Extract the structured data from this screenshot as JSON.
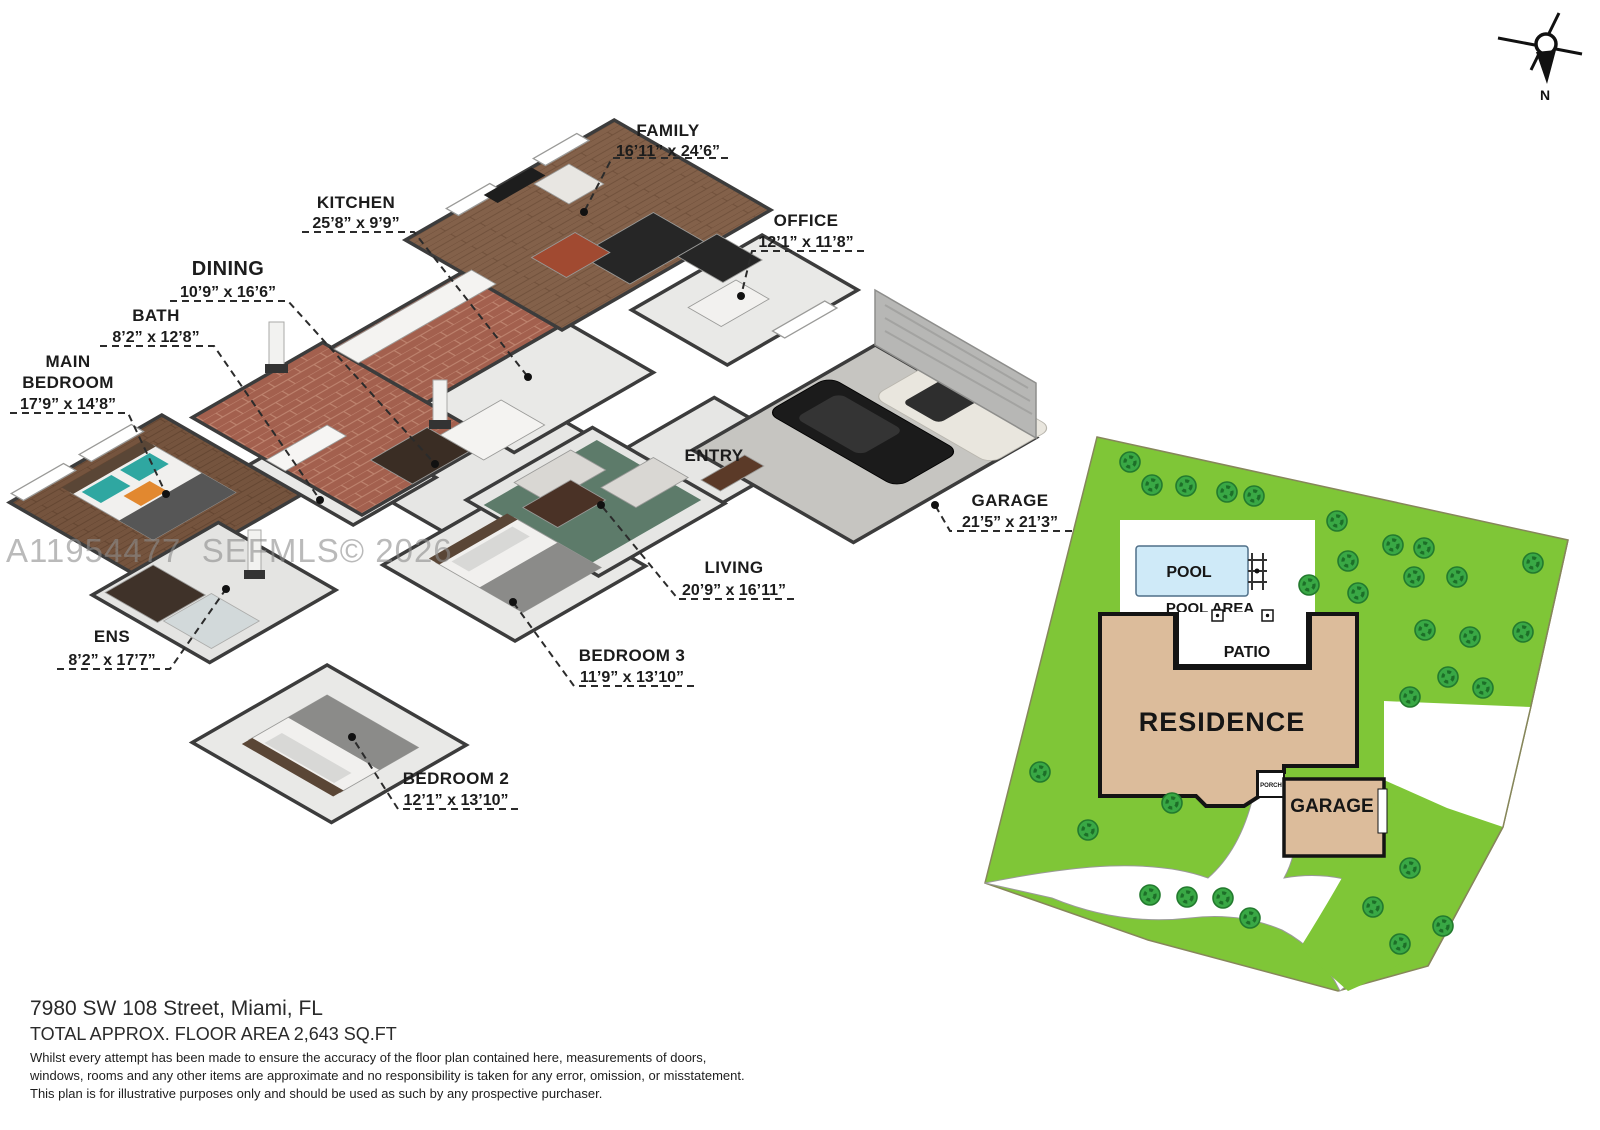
{
  "watermark": "A11954477  SEFMLS© 2026",
  "compass": {
    "north_label": "N"
  },
  "floor_plan": {
    "rooms": [
      {
        "id": "family",
        "name": "FAMILY",
        "dims": "16’11” x 24’6”"
      },
      {
        "id": "kitchen",
        "name": "KITCHEN",
        "dims": "25’8” x 9’9”"
      },
      {
        "id": "dining",
        "name": "DINING",
        "dims": "10’9” x 16’6”"
      },
      {
        "id": "bath",
        "name": "BATH",
        "dims": "8’2” x 12’8”"
      },
      {
        "id": "main-bedroom",
        "name": "MAIN BEDROOM",
        "name_lines": [
          "MAIN",
          "BEDROOM"
        ],
        "dims": "17’9” x 14’8”"
      },
      {
        "id": "office",
        "name": "OFFICE",
        "dims": "12’1” x 11’8”"
      },
      {
        "id": "entry",
        "name": "ENTRY",
        "dims": ""
      },
      {
        "id": "garage",
        "name": "GARAGE",
        "dims": "21’5” x 21’3”"
      },
      {
        "id": "living",
        "name": "LIVING",
        "dims": "20’9” x 16’11”"
      },
      {
        "id": "bedroom-3",
        "name": "BEDROOM 3",
        "dims": "11’9” x 13’10”"
      },
      {
        "id": "bedroom-2",
        "name": "BEDROOM 2",
        "dims": "12’1” x 13’10”"
      },
      {
        "id": "ens",
        "name": "ENS",
        "dims": "8’2” x 17’7”"
      }
    ]
  },
  "site_plan": {
    "labels": {
      "pool": "POOL",
      "pool_area": "POOL AREA",
      "patio": "PATIO",
      "residence": "RESIDENCE",
      "garage": "GARAGE",
      "porch": "PORCH"
    }
  },
  "footer": {
    "address": "7980 SW 108 Street, Miami, FL",
    "area": "TOTAL APPROX. FLOOR AREA 2,643 SQ.FT",
    "disclaimer_lines": [
      "Whilst every attempt has been made to ensure the accuracy of the floor plan contained here, measurements of doors,",
      "windows, rooms and any other items are approximate and no responsibility is taken for any error, omission, or misstatement.",
      "This plan is for illustrative purposes only and should be used as such by any prospective purchaser."
    ]
  },
  "colors": {
    "grass": "#7fc637",
    "tree": "#39a845",
    "pool": "#cfeaf8",
    "residence_fill": "#dcbc9b",
    "brick_floor": "#a3604e",
    "wood_family": "#83614a",
    "wood_bedroom": "#75543e",
    "rug": "#5d7b6a"
  }
}
